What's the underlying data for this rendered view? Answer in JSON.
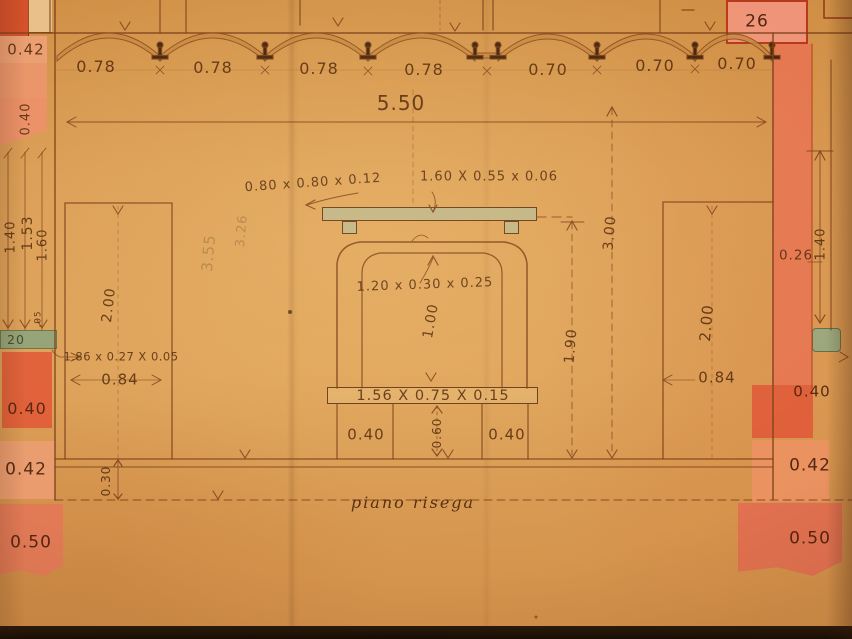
{
  "labels": {
    "bays": [
      "0.78",
      "0.78",
      "0.78",
      "0.78",
      "0.70",
      "0.70",
      "0.70"
    ],
    "overall_width": "5.50",
    "corner_block": "26",
    "left": {
      "top_042": "0.42",
      "rot_040": "0.40",
      "h_140": "1.40",
      "h_153": "1.53",
      "h_160": "1.60",
      "h_005": ".05",
      "green_20": "20",
      "mid_040": "0.40",
      "mid_042": "0.42",
      "bot_050": "0.50",
      "h_030": "0.30",
      "note_strip": "1.86 x 0.27 X 0.05",
      "panel_w": "0.84",
      "panel_h": "2.00"
    },
    "right": {
      "d_026": "0.26",
      "h_140": "1.40",
      "mid_040": "0.40",
      "mid_042": "0.42",
      "bot_050": "0.50",
      "h_300": "3.00",
      "h_190": "1.90",
      "panel_h": "2.00",
      "panel_w": "0.84"
    },
    "fireplace": {
      "board_note": "0.80 x 0.80 x 0.12",
      "shelf_note": "1.60 X 0.55 x 0.06",
      "arch_note": "1.20 x 0.30 x 0.25",
      "opening_h": "1.00",
      "hearth_note": "1.56 X 0.75 X 0.15",
      "base_left": "0.40",
      "base_mid": "0.60",
      "base_right": "0.40"
    },
    "floor_label": "piano risega",
    "ghost": {
      "a": "3.55",
      "b": "3.26"
    }
  },
  "colors": {
    "paper": "#d99b53",
    "ink": "#7b4017",
    "wall_red": "#e0603a",
    "wall_pink": "#ea9c6e",
    "ledge_green": "#93a277",
    "shelf_tan": "#c2b586"
  }
}
